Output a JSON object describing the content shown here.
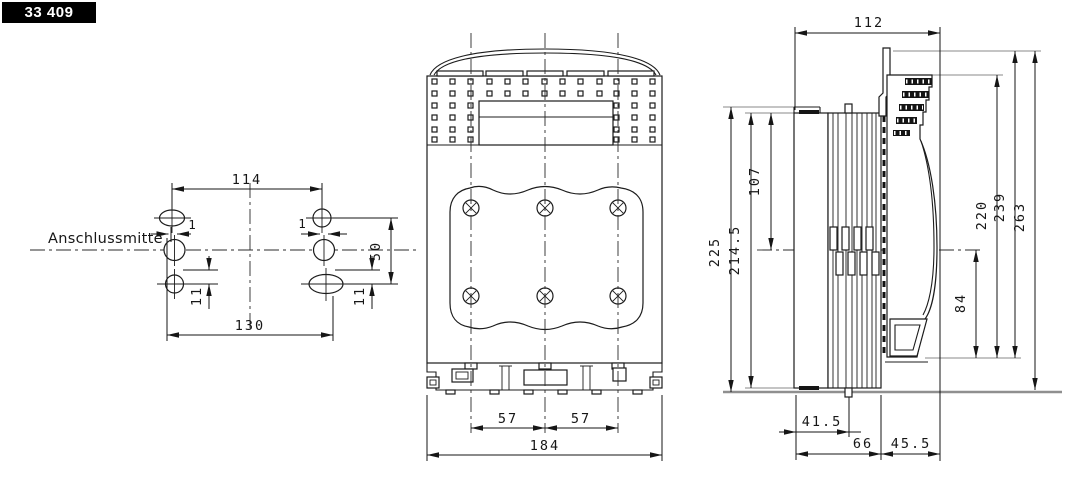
{
  "badge": {
    "part_number": "33 409"
  },
  "drilling_plan": {
    "centerline_label": "Anschlussmitte",
    "dim_top_spacing": "114",
    "dim_bottom_spacing": "130",
    "dim_vertical_spacing": "50",
    "dim_slot_left": "11",
    "dim_slot_right": "11",
    "dim_offset_left": "1",
    "dim_offset_right": "1"
  },
  "front_view": {
    "dim_pole_pitch_left": "57",
    "dim_pole_pitch_right": "57",
    "dim_overall_width": "184"
  },
  "side_view": {
    "dim_depth_top": "112",
    "dim_height_overall": "225",
    "dim_height_plates": "214.5",
    "dim_top_to_center": "107",
    "dim_center_to_bottom": "84",
    "dim_height_220": "220",
    "dim_height_239": "239",
    "dim_height_263": "263",
    "dim_depth_41_5": "41.5",
    "dim_depth_66": "66",
    "dim_depth_45_5": "45.5"
  }
}
